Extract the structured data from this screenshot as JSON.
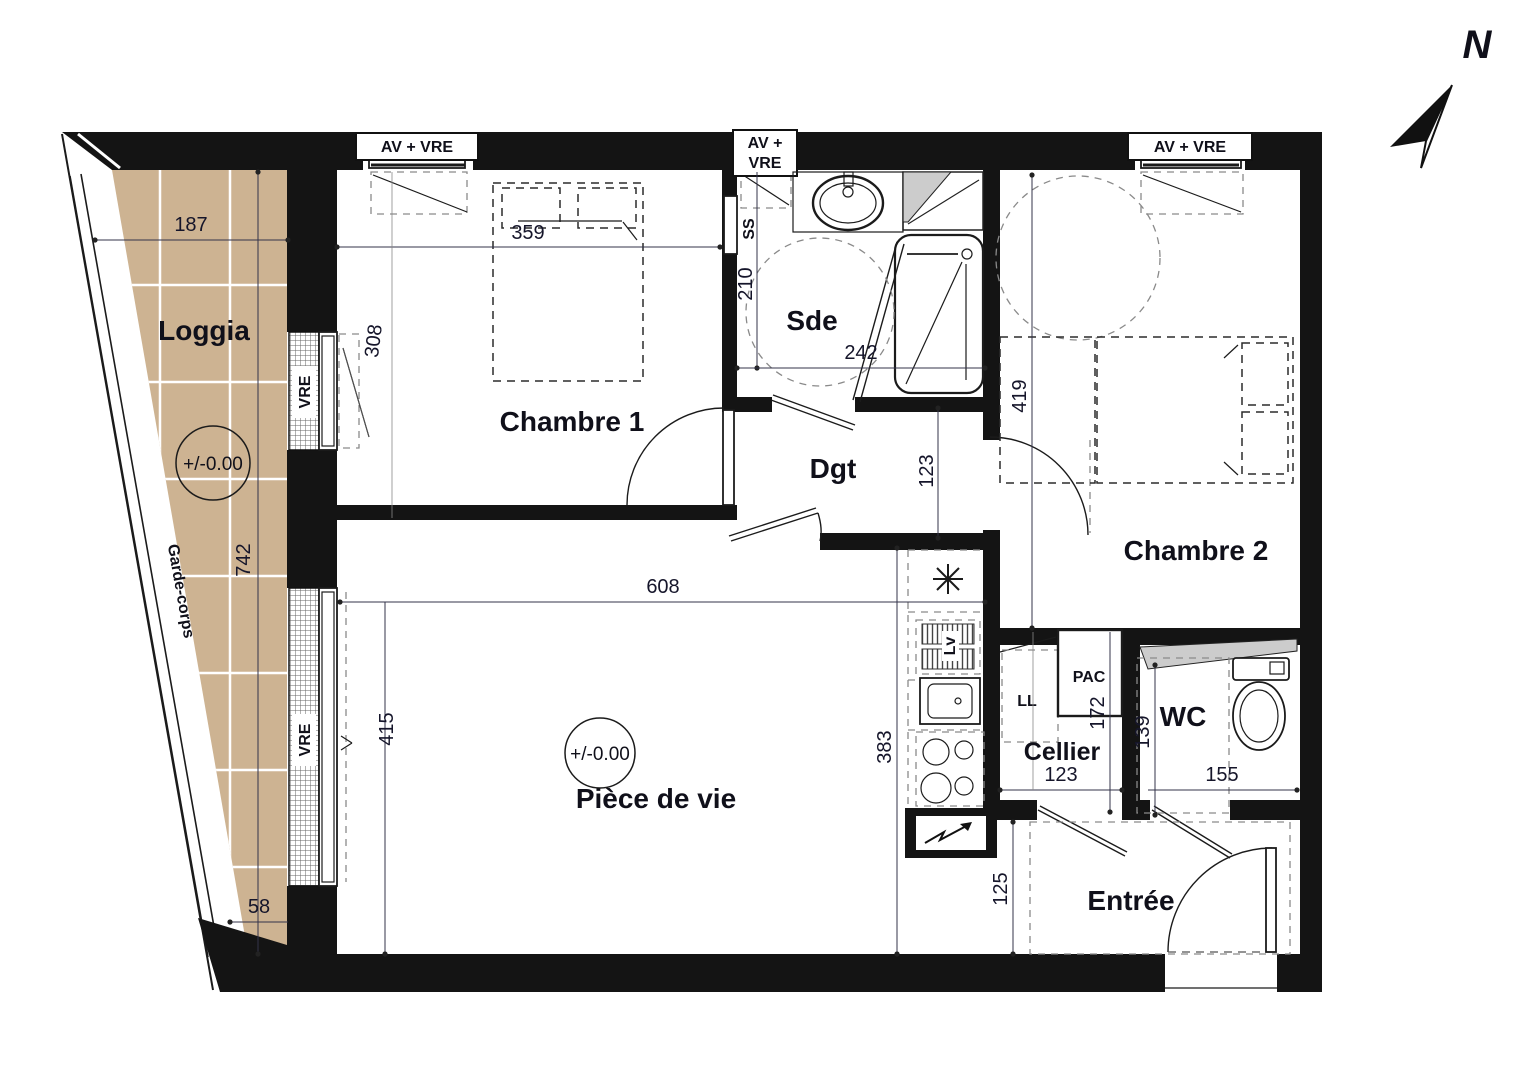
{
  "colors": {
    "wall": "#141414",
    "loggia_fill": "#cdb392",
    "duct_fill": "#cccccc",
    "dim_text": "#15152a",
    "label_text": "#10101a"
  },
  "north": {
    "label": "N"
  },
  "rooms": {
    "loggia": "Loggia",
    "chambre1": "Chambre 1",
    "sde": "Sde",
    "dgt": "Dgt",
    "chambre2": "Chambre 2",
    "piece_de_vie": "Pièce de vie",
    "cellier": "Cellier",
    "wc": "WC",
    "entree": "Entrée"
  },
  "levels": {
    "loggia": "+/-0.00",
    "piece_de_vie": "+/-0.00"
  },
  "windows": {
    "w1": "AV + VRE",
    "w2a": "AV +",
    "w2b": "VRE",
    "w3": "AV + VRE",
    "vre_upper": "VRE",
    "vre_lower": "VRE"
  },
  "equipment": {
    "ss": "SS",
    "lv": "Lv",
    "ll": "LL",
    "pac": "PAC"
  },
  "railing": {
    "label": "Garde-corps"
  },
  "dims": {
    "loggia_w": "187",
    "loggia_h": "742",
    "loggia_b": "58",
    "vre_up": "308",
    "ch1_w": "359",
    "sde_h": "210",
    "sde_w": "242",
    "dgt_w": "123",
    "ch2_h": "419",
    "pdv_w": "608",
    "pdv_h": "415",
    "kitchen_h": "383",
    "cellier_h": "172",
    "cellier_w": "123",
    "wc_h": "139",
    "wc_w": "155",
    "entree_h": "125"
  }
}
